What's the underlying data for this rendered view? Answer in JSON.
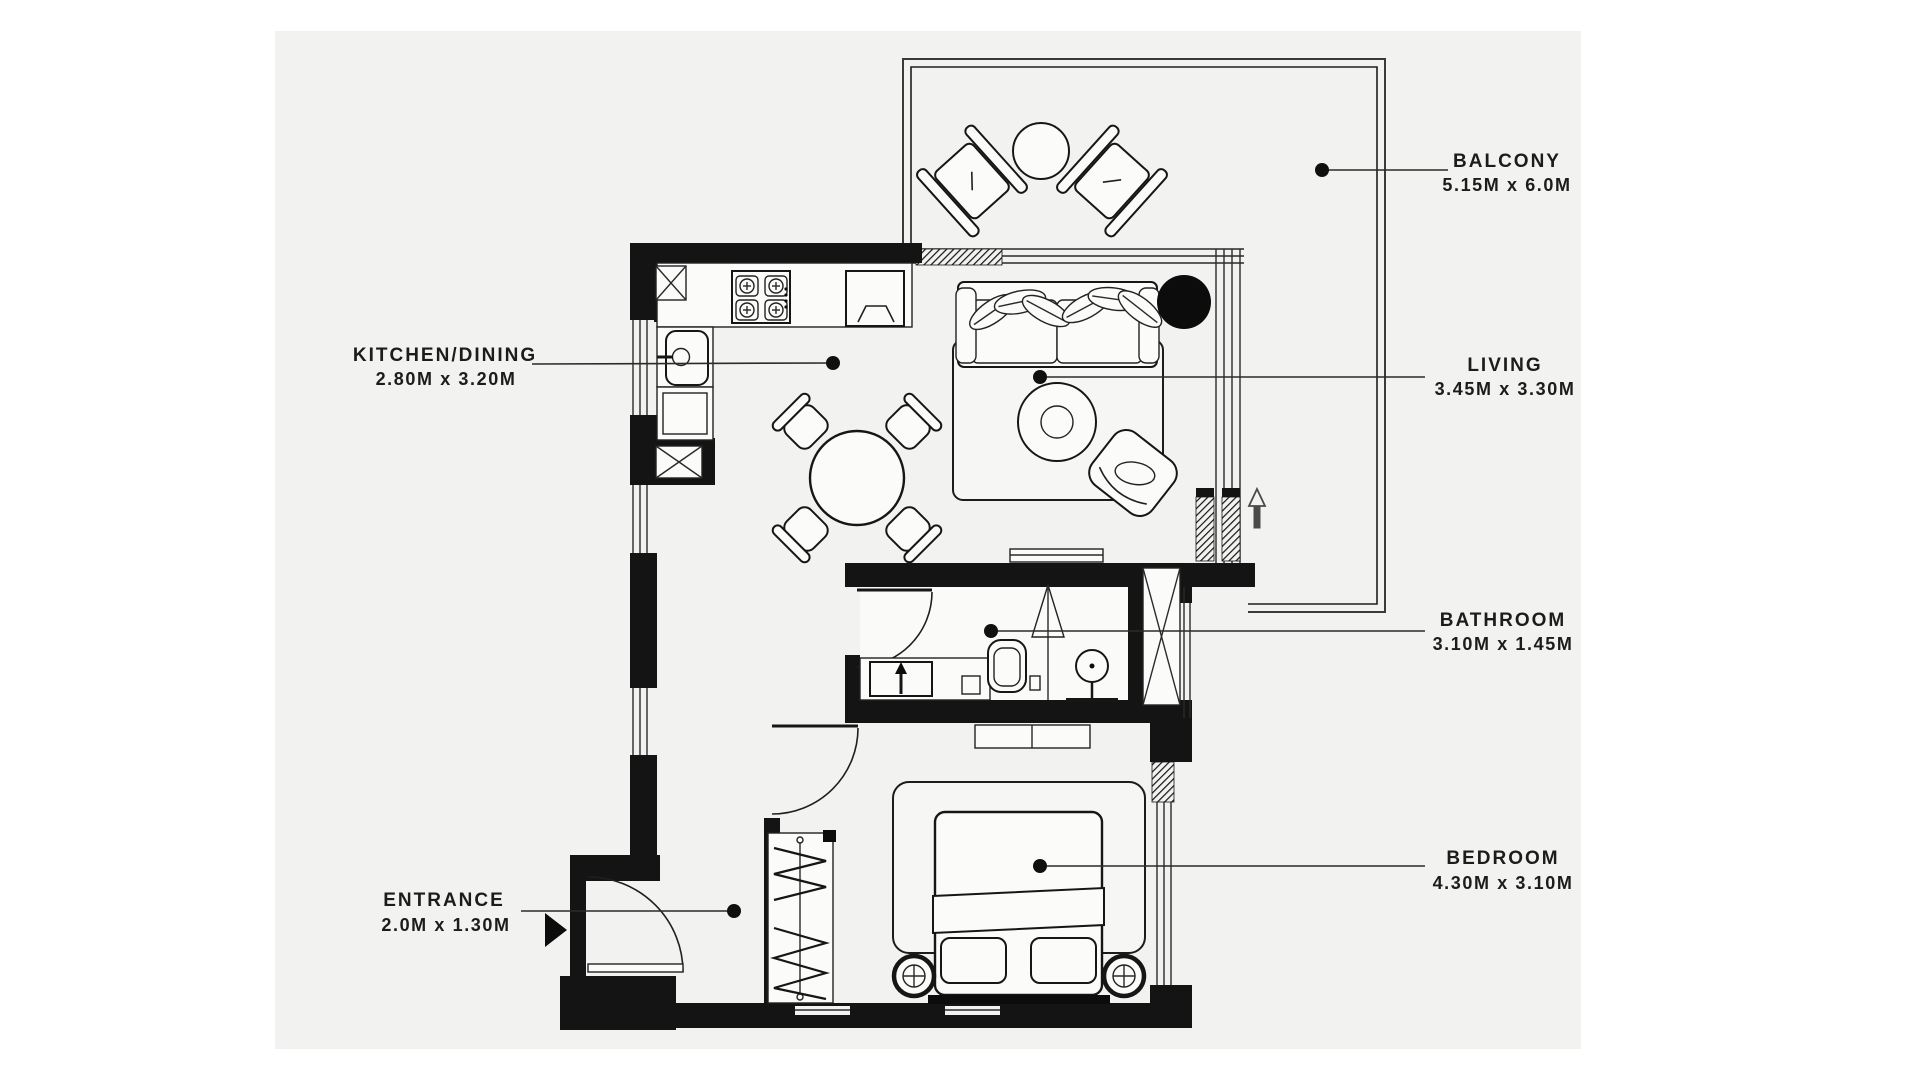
{
  "page": {
    "background": "#ffffff",
    "panel_color": "#f2f2f0",
    "wall_color": "#141414",
    "text_color": "#1c1c1c"
  },
  "floorplan": {
    "rooms": [
      {
        "id": "balcony",
        "label": "BALCONY",
        "dims": "5.15M x 6.0M"
      },
      {
        "id": "kitchen-dining",
        "label": "KITCHEN/DINING",
        "dims": "2.80M x 3.20M"
      },
      {
        "id": "living",
        "label": "LIVING",
        "dims": "3.45M x 3.30M"
      },
      {
        "id": "bathroom",
        "label": "BATHROOM",
        "dims": "3.10M x 1.45M"
      },
      {
        "id": "bedroom",
        "label": "BEDROOM",
        "dims": "4.30M x 3.10M"
      },
      {
        "id": "entrance",
        "label": "ENTRANCE",
        "dims": "2.0M x 1.30M"
      }
    ]
  }
}
